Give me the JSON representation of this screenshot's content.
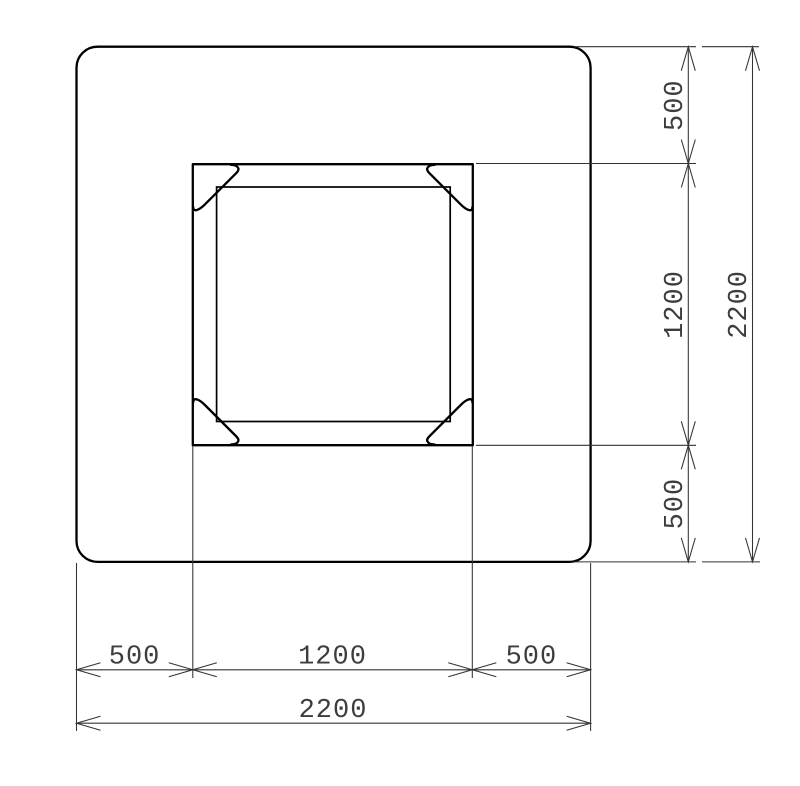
{
  "drawing": {
    "type": "plan-section-technical-drawing",
    "background_color": "#ffffff",
    "outline_color": "#000000",
    "dimension_line_color": "#333333",
    "dimension_text_color": "#3d3d3d"
  },
  "dimensions": {
    "right": {
      "top": "500",
      "middle": "1200",
      "bottom": "500",
      "overall": "2200"
    },
    "bottom": {
      "left": "500",
      "center": "1200",
      "right": "500",
      "overall": "2200"
    }
  }
}
